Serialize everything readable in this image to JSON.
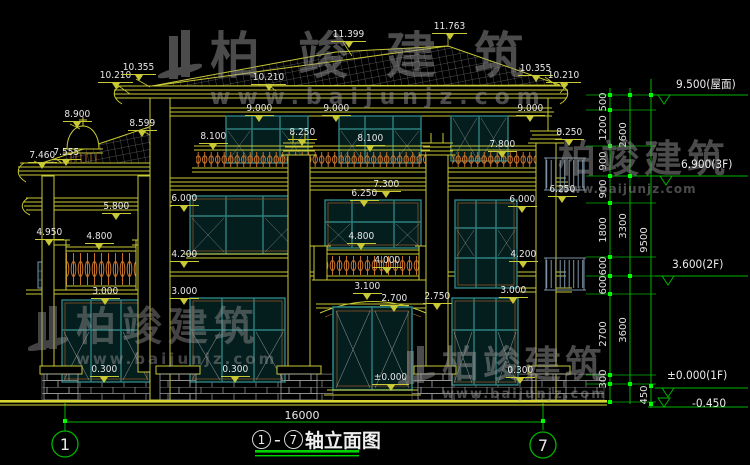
{
  "watermark": {
    "brand": "柏竣建筑",
    "url": "www.baijunjz.com"
  },
  "watermark_instances": [
    {
      "x": 156,
      "y": 30,
      "brand_size": 50,
      "brand_ls": 38,
      "url_size": 22,
      "url_ls": 7,
      "logo": true,
      "logo_w": 48,
      "logo_h": 64,
      "alpha": 0.5
    },
    {
      "x": 26,
      "y": 306,
      "brand_size": 40,
      "brand_ls": 6,
      "url_size": 15,
      "url_ls": 3,
      "logo": true,
      "logo_w": 44,
      "logo_h": 58,
      "alpha": 0.45
    },
    {
      "x": 558,
      "y": 140,
      "brand_size": 38,
      "brand_ls": 5,
      "url_size": 12,
      "url_ls": 1,
      "logo": false,
      "logo_w": 0,
      "logo_h": 0,
      "alpha": 0.5
    },
    {
      "x": 396,
      "y": 346,
      "brand_size": 37,
      "brand_ls": 4,
      "url_size": 13,
      "url_ls": 2,
      "logo": true,
      "logo_w": 40,
      "logo_h": 50,
      "alpha": 0.5
    }
  ],
  "elevation_labels": [
    {
      "text": "11.399",
      "x": 331,
      "y": 29
    },
    {
      "text": "11.763",
      "x": 432,
      "y": 21
    },
    {
      "text": "10.210",
      "x": 98,
      "y": 70
    },
    {
      "text": "10.355",
      "x": 121,
      "y": 62
    },
    {
      "text": "10.210",
      "x": 251,
      "y": 72
    },
    {
      "text": "10.355",
      "x": 518,
      "y": 63
    },
    {
      "text": "10.210",
      "x": 546,
      "y": 70
    },
    {
      "text": "8.900",
      "x": 63,
      "y": 109
    },
    {
      "text": "8.599",
      "x": 128,
      "y": 118
    },
    {
      "text": "9.000",
      "x": 245,
      "y": 103
    },
    {
      "text": "9.000",
      "x": 322,
      "y": 103
    },
    {
      "text": "9.000",
      "x": 516,
      "y": 103
    },
    {
      "text": "8.100",
      "x": 199,
      "y": 131
    },
    {
      "text": "8.250",
      "x": 288,
      "y": 127
    },
    {
      "text": "8.100",
      "x": 356,
      "y": 133
    },
    {
      "text": "7.800",
      "x": 488,
      "y": 139
    },
    {
      "text": "8.250",
      "x": 555,
      "y": 127
    },
    {
      "text": "7.460",
      "x": 28,
      "y": 150
    },
    {
      "text": "7.555",
      "x": 52,
      "y": 147
    },
    {
      "text": "7.300",
      "x": 372,
      "y": 179
    },
    {
      "text": "6.250",
      "x": 350,
      "y": 188
    },
    {
      "text": "6.250",
      "x": 548,
      "y": 184
    },
    {
      "text": "6.000",
      "x": 170,
      "y": 193
    },
    {
      "text": "6.000",
      "x": 508,
      "y": 194
    },
    {
      "text": "5.800",
      "x": 102,
      "y": 201
    },
    {
      "text": "4.950",
      "x": 35,
      "y": 227
    },
    {
      "text": "4.800",
      "x": 85,
      "y": 231
    },
    {
      "text": "4.800",
      "x": 347,
      "y": 231
    },
    {
      "text": "4.200",
      "x": 170,
      "y": 249
    },
    {
      "text": "4.200",
      "x": 509,
      "y": 249
    },
    {
      "text": "4.000",
      "x": 373,
      "y": 255
    },
    {
      "text": "3.000",
      "x": 91,
      "y": 286
    },
    {
      "text": "3.000",
      "x": 170,
      "y": 286
    },
    {
      "text": "3.100",
      "x": 353,
      "y": 281
    },
    {
      "text": "3.000",
      "x": 499,
      "y": 285
    },
    {
      "text": "2.700",
      "x": 380,
      "y": 293
    },
    {
      "text": "2.750",
      "x": 423,
      "y": 291
    },
    {
      "text": "0.300",
      "x": 90,
      "y": 364
    },
    {
      "text": "0.300",
      "x": 221,
      "y": 364
    },
    {
      "text": "0.300",
      "x": 506,
      "y": 365
    },
    {
      "text": "±0.000",
      "x": 372,
      "y": 372
    }
  ],
  "level_markers": [
    {
      "text": "9.500(屋面)",
      "x": 676,
      "y": 76
    },
    {
      "text": "6.900(3F)",
      "x": 681,
      "y": 157
    },
    {
      "text": "3.600(2F)",
      "x": 672,
      "y": 257
    },
    {
      "text": "±0.000(1F)",
      "x": 667,
      "y": 368
    },
    {
      "text": "-0.450",
      "x": 692,
      "y": 396
    }
  ],
  "dimension_chains": {
    "inner": {
      "x": 610,
      "labels": [
        [
          "500",
          102
        ],
        [
          "1200",
          128
        ],
        [
          "900",
          161
        ],
        [
          "900",
          189
        ],
        [
          "1800",
          230
        ],
        [
          "600",
          266
        ],
        [
          "600",
          285
        ],
        [
          "2700",
          334
        ],
        [
          "300",
          379
        ]
      ]
    },
    "middle": {
      "x": 630,
      "labels": [
        [
          "2600",
          135
        ],
        [
          "3300",
          226
        ],
        [
          "3600",
          330
        ]
      ]
    },
    "outer": {
      "x": 651,
      "labels": [
        [
          "9500",
          240
        ],
        [
          "450",
          395
        ]
      ]
    }
  },
  "bottom": {
    "overall_dim": "16000",
    "axis_from": "1",
    "axis_to": "7",
    "drawing_name": "轴立面图",
    "title_full": "①-⑦轴立面图"
  }
}
